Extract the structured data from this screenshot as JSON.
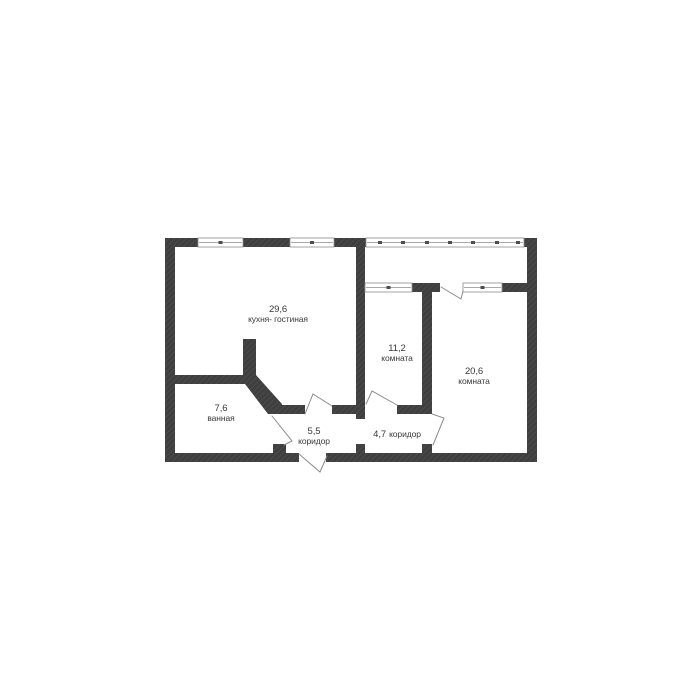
{
  "colors": {
    "wall": "#3f3f3f",
    "thin_line": "#8c8c8c",
    "text": "#3a3a3a",
    "background": "#ffffff"
  },
  "rooms": [
    {
      "area": "29,6",
      "label": "кухня- гостиная"
    },
    {
      "area": "11,2",
      "label": "комната"
    },
    {
      "area": "20,6",
      "label": "комната"
    },
    {
      "area": "7,6",
      "label": "ванная"
    },
    {
      "area": "5,5",
      "label": "коридор"
    },
    {
      "area": "4,7",
      "label": "коридор"
    }
  ]
}
